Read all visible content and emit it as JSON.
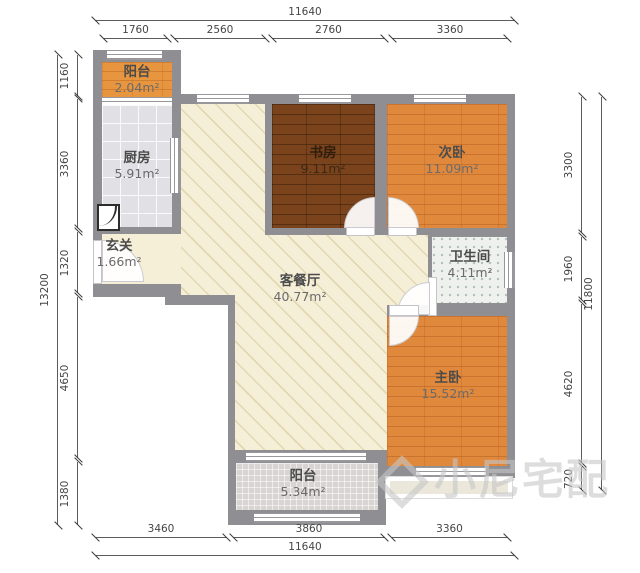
{
  "floorplan": {
    "rooms": {
      "balcony_top": {
        "name": "阳台",
        "area": "2.04m²"
      },
      "kitchen": {
        "name": "厨房",
        "area": "5.91m²"
      },
      "entry": {
        "name": "玄关",
        "area": "1.66m²"
      },
      "study": {
        "name": "书房",
        "area": "9.11m²"
      },
      "bedroom_second": {
        "name": "次卧",
        "area": "11.09m²"
      },
      "bathroom": {
        "name": "卫生间",
        "area": "4.11m²"
      },
      "living_dining": {
        "name": "客餐厅",
        "area": "40.77m²"
      },
      "bedroom_master": {
        "name": "主卧",
        "area": "15.52m²"
      },
      "balcony_bottom": {
        "name": "阳台",
        "area": "5.34m²"
      }
    },
    "dimensions": {
      "top": {
        "total": "11640",
        "segments": [
          "1760",
          "2560",
          "2760",
          "3360"
        ]
      },
      "bottom": {
        "total": "11640",
        "segments": [
          "3460",
          "3860",
          "3360"
        ]
      },
      "left": {
        "total": "13200",
        "segments": [
          "1160",
          "3360",
          "1320",
          "4650",
          "1380"
        ]
      },
      "right": {
        "total": "11800",
        "segments": [
          "3300",
          "1960",
          "4620",
          "720"
        ]
      }
    },
    "watermark": {
      "text": "小尼宅配"
    },
    "colors": {
      "wall": "#8f8f93",
      "wood_orange": "#e0893c",
      "wood_dark": "#7a431c",
      "living_floor": "#f5efd8",
      "kitchen_tile": "#e1e1e5",
      "bath_tile": "#eef1ed",
      "balcony_tile": "#d7d4d1"
    }
  }
}
